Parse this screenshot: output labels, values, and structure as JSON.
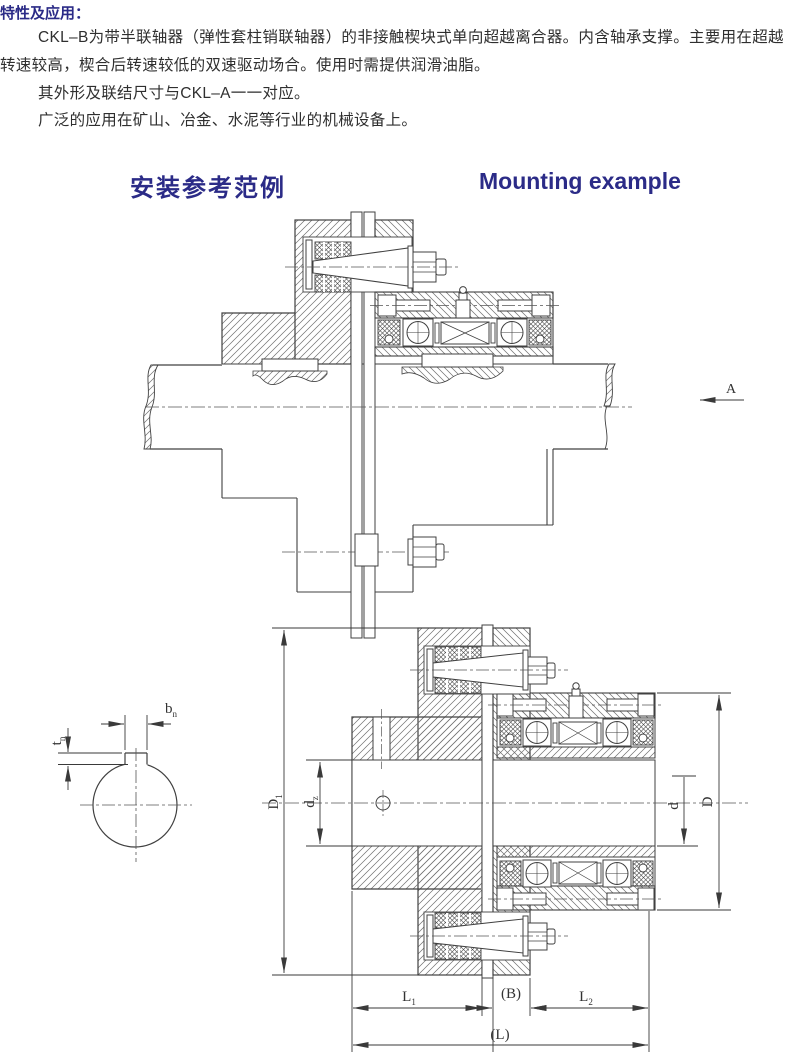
{
  "page": {
    "title_zh": "特性及应用：",
    "body_lines": [
      "CKL–B为带半联轴器（弹性套柱销联轴器）的非接触楔块式单向超越离合器。内含轴承支撑。主要用在超越",
      "转速较高，楔合后转速较低的双速驱动场合。使用时需提供润滑油脂。",
      "其外形及联结尺寸与CKL–A一一对应。",
      "广泛的应用在矿山、冶金、水泥等行业的机械设备上。"
    ],
    "section_heading_zh": "安装参考范例",
    "section_heading_en": "Mounting example"
  },
  "drawing": {
    "view_label": "A",
    "dims": {
      "b_n": {
        "main": "b",
        "sub": "n"
      },
      "t_n": {
        "main": "t",
        "sub": "n"
      },
      "D1": {
        "main": "D",
        "sub": "1"
      },
      "d_z": {
        "main": "d",
        "sub": "z"
      },
      "d": {
        "main": "d"
      },
      "D": {
        "main": "D"
      },
      "L1": {
        "main": "L",
        "sub": "1"
      },
      "B": {
        "main": "(B)"
      },
      "L2": {
        "main": "L",
        "sub": "2"
      },
      "L": {
        "main": "(L)"
      }
    }
  },
  "colors": {
    "heading": "#2b2b87",
    "body": "#2f2f2f",
    "line": "#404040"
  }
}
